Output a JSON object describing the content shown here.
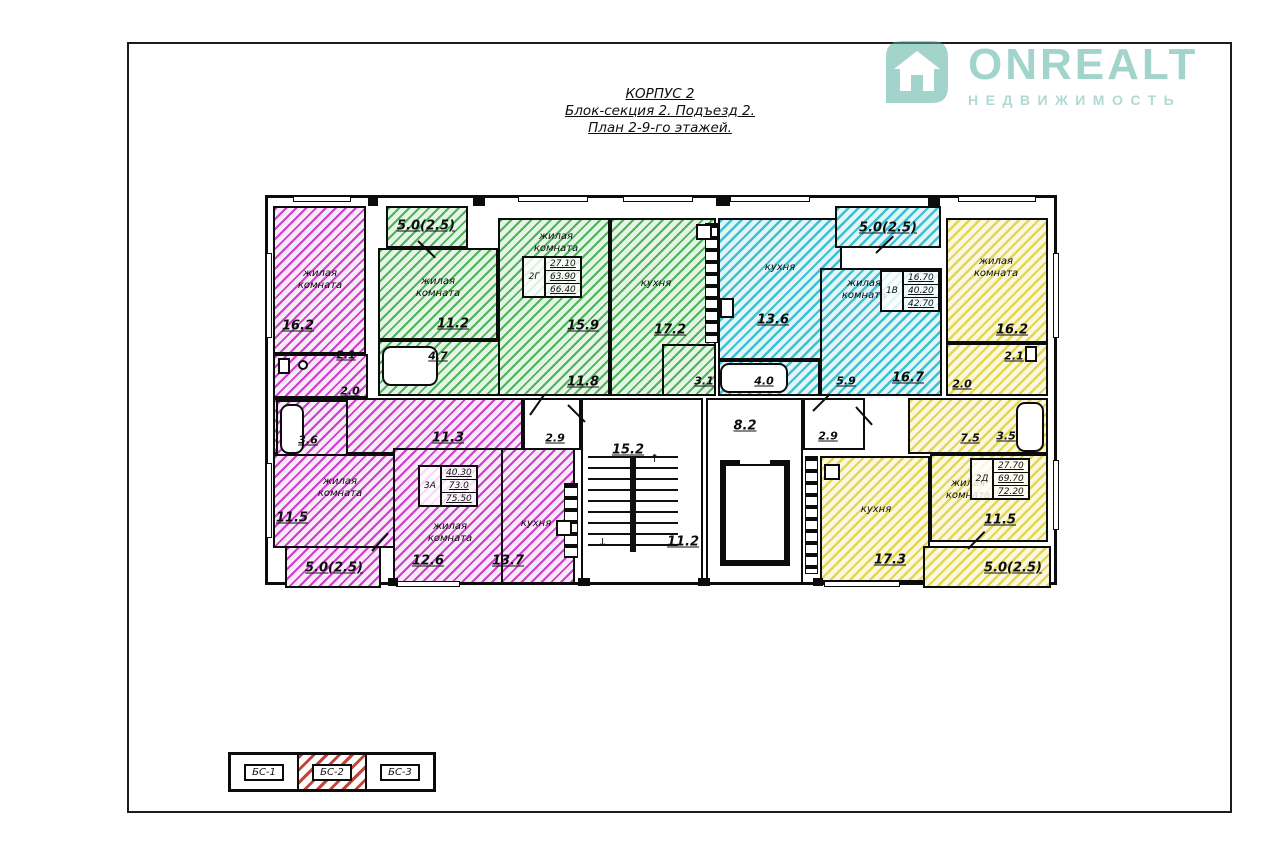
{
  "title": {
    "l1": "КОРПУС 2",
    "l2": "Блок-секция 2. Подъезд 2.",
    "l3": "План 2-9-го этажей."
  },
  "logo": {
    "brand": "ONREALT",
    "tagline": "НЕДВИЖИМОСТЬ",
    "accent_color": "#57b2a4"
  },
  "core": {
    "stair": "15.2",
    "corridor": "11.2",
    "elevator": "8.2",
    "vest_left": "2.9",
    "vest_right": "2.9"
  },
  "apartments": {
    "a3a": {
      "code": "3А",
      "stamp": [
        "40.30",
        "73.0",
        "75.50"
      ],
      "balcony": "5.0(2.5)",
      "rooms": {
        "living1": {
          "label": "жилая комната",
          "area": "16.2"
        },
        "wc": {
          "area": "2.1"
        },
        "hall": {
          "area": "2.0"
        },
        "bath": {
          "area": "3.6"
        },
        "living2": {
          "label": "жилая комната",
          "area": "11.5"
        },
        "corridor": {
          "area": "11.3"
        },
        "living3": {
          "label": "жилая комната",
          "area": "12.6"
        },
        "kitchen": {
          "label": "кухня",
          "area": "13.7"
        }
      }
    },
    "a2g": {
      "code": "2Г",
      "stamp": [
        "27.10",
        "63.90",
        "66.40"
      ],
      "balcony": "5.0(2.5)",
      "rooms": {
        "living1": {
          "label": "жилая комната",
          "area": "11.2"
        },
        "living2": {
          "label": "жилая комната",
          "area": "15.9"
        },
        "kitchen": {
          "label": "кухня",
          "area": "17.2"
        },
        "corridor": {
          "area": "11.8"
        },
        "bath": {
          "area": "4.7"
        },
        "store": {
          "area": "3.1"
        }
      }
    },
    "a1v": {
      "code": "1В",
      "stamp": [
        "16.70",
        "40.20",
        "42.70"
      ],
      "balcony": "5.0(2.5)",
      "rooms": {
        "kitchen": {
          "label": "кухня",
          "area": "13.6"
        },
        "living": {
          "label": "жилая комната",
          "area": "16.7"
        },
        "corridor": {
          "area": "5.9"
        },
        "bath": {
          "area": "4.0"
        }
      }
    },
    "a2d": {
      "code": "2Д",
      "stamp": [
        "27.70",
        "69.70",
        "72.20"
      ],
      "balcony": "5.0(2.5)",
      "rooms": {
        "living1": {
          "label": "жилая комната",
          "area": "16.2"
        },
        "wc": {
          "area": "2.1"
        },
        "hall": {
          "area": "2.0"
        },
        "corridor": {
          "area": "7.5"
        },
        "bath": {
          "area": "3.5"
        },
        "living2": {
          "label": "жилая комната",
          "area": "11.5"
        },
        "kitchen": {
          "label": "кухня",
          "area": "17.3"
        }
      }
    }
  },
  "legend": {
    "items": [
      "БС-1",
      "БС-2",
      "БС-3"
    ]
  },
  "colors": {
    "magenta": "#c934c9",
    "green": "#37ab46",
    "cyan": "#34bdd0",
    "yellow": "#e2d44a",
    "legend_red": "#bf3a2b"
  }
}
